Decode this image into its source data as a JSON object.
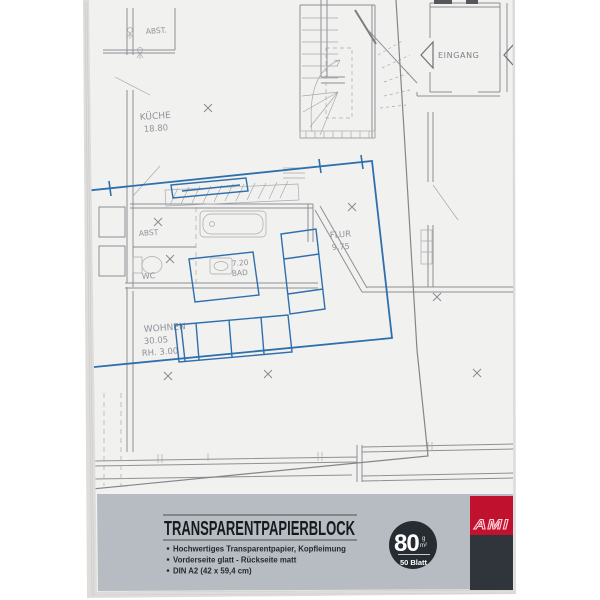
{
  "colors": {
    "band": "#b6bcc2",
    "badge": "#262c31",
    "brand_red": "#c0122f",
    "brand_dark": "#2f353b",
    "blue": "#2f6fad",
    "plan_line": "#989898"
  },
  "band": {
    "title": "TRANSPARENTPAPIERBLOCK",
    "features": [
      "Hochwertiges Transparentpapier, Kopfleimung",
      "Vorderseite glatt - Rückseite matt",
      "DIN A2 (42 x 59,4 cm)"
    ],
    "badge": {
      "weight": "80",
      "unit_top": "g",
      "unit_bottom": "m²",
      "sheets": "50 Blatt"
    },
    "brand": "AMI"
  },
  "floor_plan": {
    "labels": {
      "storage_top": "ABST.",
      "kitchen": "KÜCHE",
      "kitchen_area": "18.80",
      "storage": "ABST",
      "wc": "WC",
      "bath_area": "7.20",
      "bath": "BAD",
      "hall": "FLUR",
      "hall_area": "9.75",
      "living": "WOHNEN",
      "living_area": "30.05",
      "living_height": "RH. 3.00",
      "entrance": "EINGANG"
    }
  }
}
